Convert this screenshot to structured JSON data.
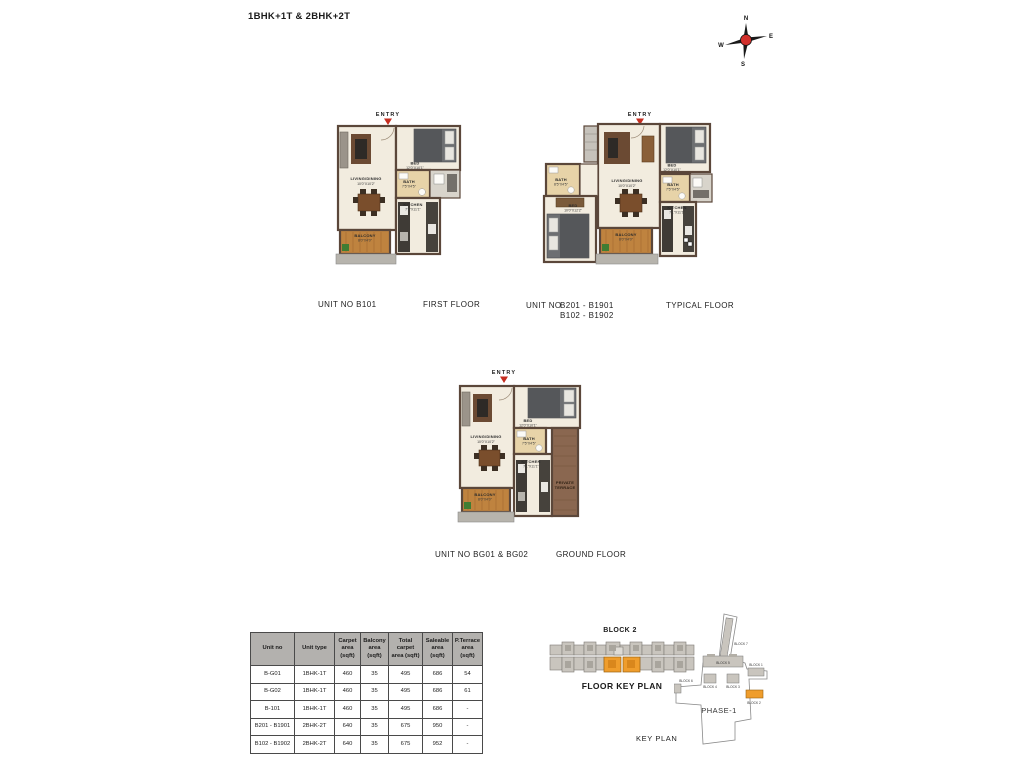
{
  "page": {
    "title": "1BHK+1T & 2BHK+2T"
  },
  "compass": {
    "n": "N",
    "e": "E",
    "s": "S",
    "w": "W"
  },
  "plans": {
    "first": {
      "entry": "ENTRY",
      "unit_label": "UNIT NO  B101",
      "floor_label": "FIRST FLOOR",
      "rooms": {
        "living": {
          "name": "LIVING/DINING",
          "dims": "10'0\"X10'2\""
        },
        "bed": {
          "name": "BED",
          "dims": "12'0\"X10'1\""
        },
        "bath": {
          "name": "BATH",
          "dims": "7'5\"X4'5\""
        },
        "kitchen": {
          "name": "KITCHEN",
          "dims": "7'1\"X11'1\""
        },
        "balcony": {
          "name": "BALCONY",
          "dims": "8'0\"X4'0\""
        }
      }
    },
    "typical": {
      "entry": "ENTRY",
      "unit_label": "UNIT NO",
      "unit_numbers_line1": "B201 - B1901",
      "unit_numbers_line2": "B102 - B1902",
      "floor_label": "TYPICAL FLOOR",
      "rooms": {
        "living": {
          "name": "LIVING/DINING",
          "dims": "10'0\"X10'2\""
        },
        "bed1": {
          "name": "BED",
          "dims": "12'0\"X10'1\""
        },
        "bed2": {
          "name": "BED",
          "dims": "10'0\"X12'2\""
        },
        "bath1": {
          "name": "BATH",
          "dims": "8'5\"X4'5\""
        },
        "bath2": {
          "name": "BATH",
          "dims": "7'5\"X4'5\""
        },
        "kitchen": {
          "name": "KITCHEN",
          "dims": "7'1\"X11'1\""
        },
        "balcony": {
          "name": "BALCONY",
          "dims": "8'0\"X4'0\""
        }
      }
    },
    "ground": {
      "entry": "ENTRY",
      "unit_label": "UNIT NO  BG01 & BG02",
      "floor_label": "GROUND FLOOR",
      "rooms": {
        "living": {
          "name": "LIVING/DINING",
          "dims": "10'0\"X10'2\""
        },
        "bed": {
          "name": "BED",
          "dims": "12'0\"X10'1\""
        },
        "bath": {
          "name": "BATH",
          "dims": "7'5\"X4'5\""
        },
        "kitchen": {
          "name": "KITCHEN",
          "dims": "7'1\"X11'1\""
        },
        "balcony": {
          "name": "BALCONY",
          "dims": "8'0\"X4'0\""
        },
        "terrace": {
          "line1": "PRIVATE",
          "line2": "TERRACE"
        }
      }
    }
  },
  "table": {
    "headers": [
      "Unit no",
      "Unit type",
      "Carpet\narea\n(sqft)",
      "Balcony\narea\n(sqft)",
      "Total\ncarpet\narea (sqft)",
      "Saleable\narea\n(sqft)",
      "P.Terrace\narea\n(sqft)"
    ],
    "rows": [
      [
        "B-G01",
        "1BHK-1T",
        "460",
        "35",
        "495",
        "686",
        "54"
      ],
      [
        "B-G02",
        "1BHK-1T",
        "460",
        "35",
        "495",
        "686",
        "61"
      ],
      [
        "B-101",
        "1BHK-1T",
        "460",
        "35",
        "495",
        "686",
        "-"
      ],
      [
        "B201 - B1901",
        "2BHK-2T",
        "640",
        "35",
        "675",
        "950",
        "-"
      ],
      [
        "B102 - B1902",
        "2BHK-2T",
        "640",
        "35",
        "675",
        "952",
        "-"
      ]
    ]
  },
  "floor_key_plan": {
    "block_label": "BLOCK 2",
    "caption": "FLOOR KEY PLAN"
  },
  "key_plan": {
    "caption": "KEY PLAN",
    "phase": "PHASE-1",
    "blocks": {
      "b7": "BLOCK 7",
      "b6": "BLOCK 6",
      "b5": "BLOCK 5",
      "b4": "BLOCK 4",
      "b3": "BLOCK 3",
      "b1": "BLOCK 1",
      "b2": "BLOCK 2"
    }
  },
  "colors": {
    "highlight_orange": "#ef9d2c",
    "wall_brown": "#5b473a",
    "floor_cream": "#f2ecdf",
    "entry_red": "#c62e21"
  }
}
